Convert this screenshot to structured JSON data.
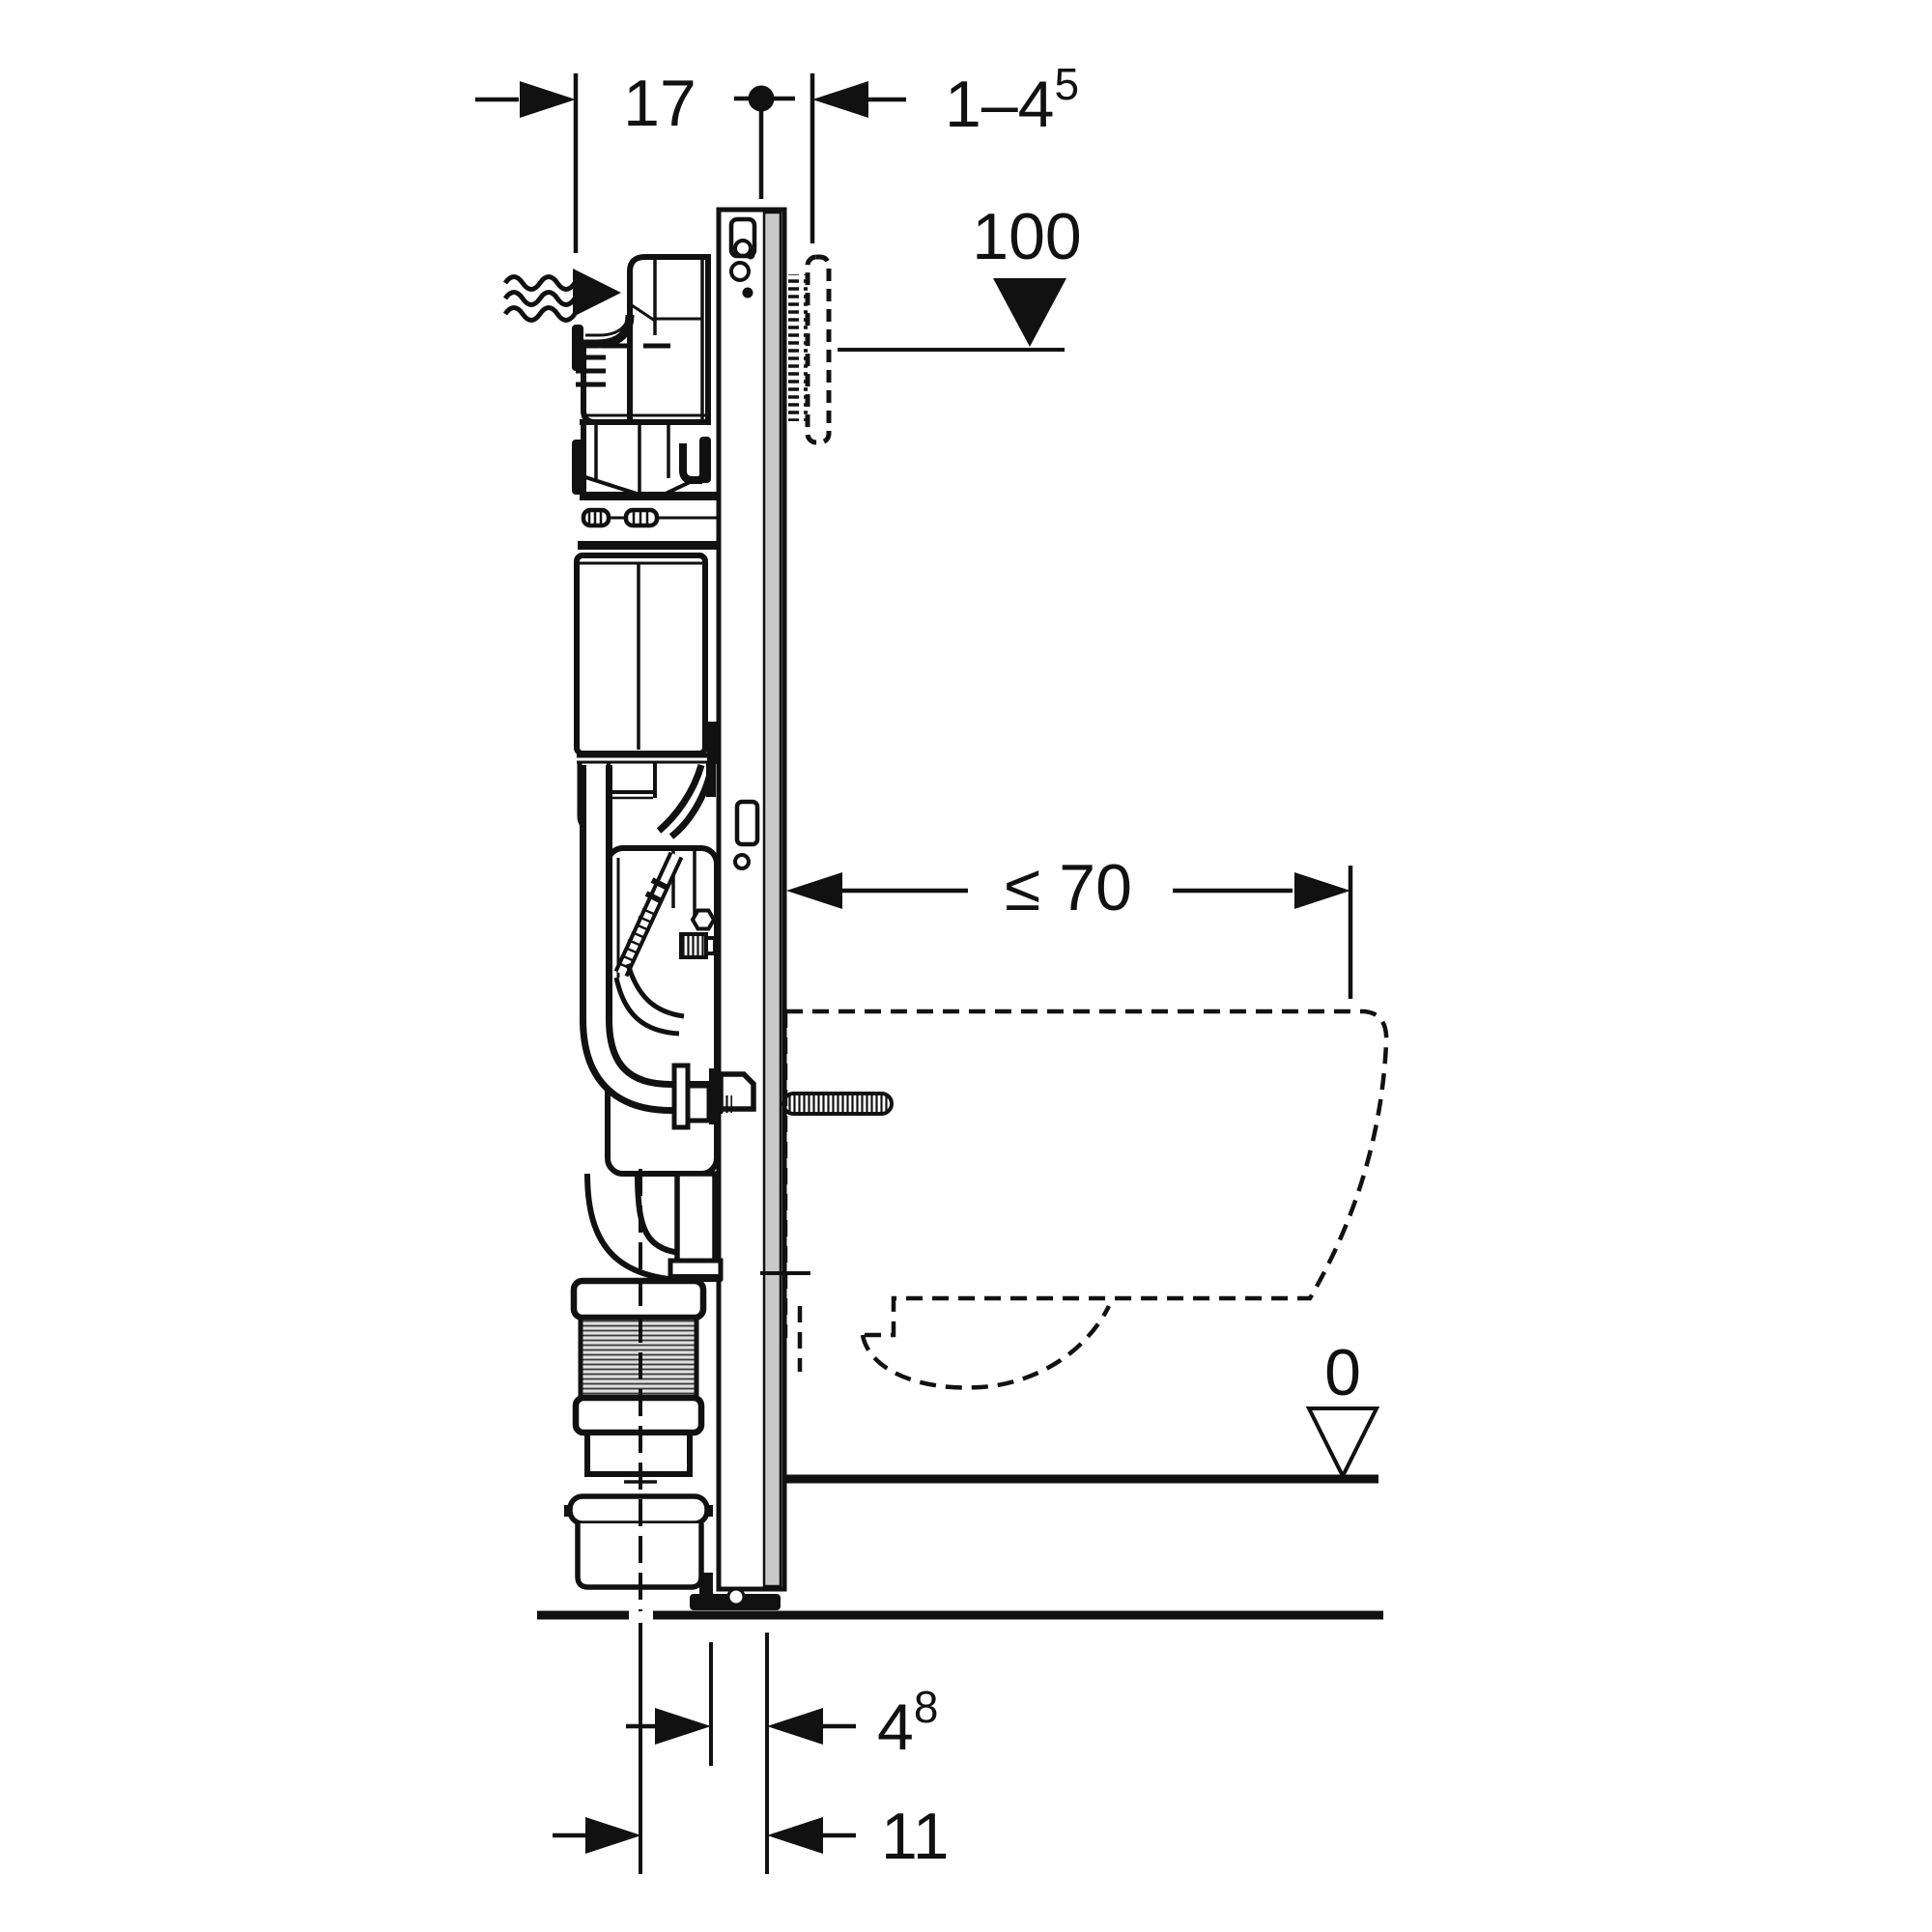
{
  "page": {
    "background": "#ffffff",
    "line_color": "#111111",
    "rail_gray": "#c9c9c9",
    "corrugation_gray": "#e0e0e0"
  },
  "labels": {
    "frame_depth": "17",
    "plate_distance_base": "1–4",
    "plate_distance_sup": "5",
    "actuation_height": "100",
    "max_fixture_depth": "≤ 70",
    "floor_level": "0",
    "front_offset_base": "4",
    "front_offset_sup": "8",
    "drain_offset": "11"
  },
  "icons": {
    "water_supply": "wavy-lines-with-filled-right-arrow",
    "dimension_arrow": "filled-triangle",
    "datum_marker": "filled-circle-with-crosshair",
    "height_marker": "filled-down-triangle",
    "floor_level_marker": "open-down-triangle"
  }
}
